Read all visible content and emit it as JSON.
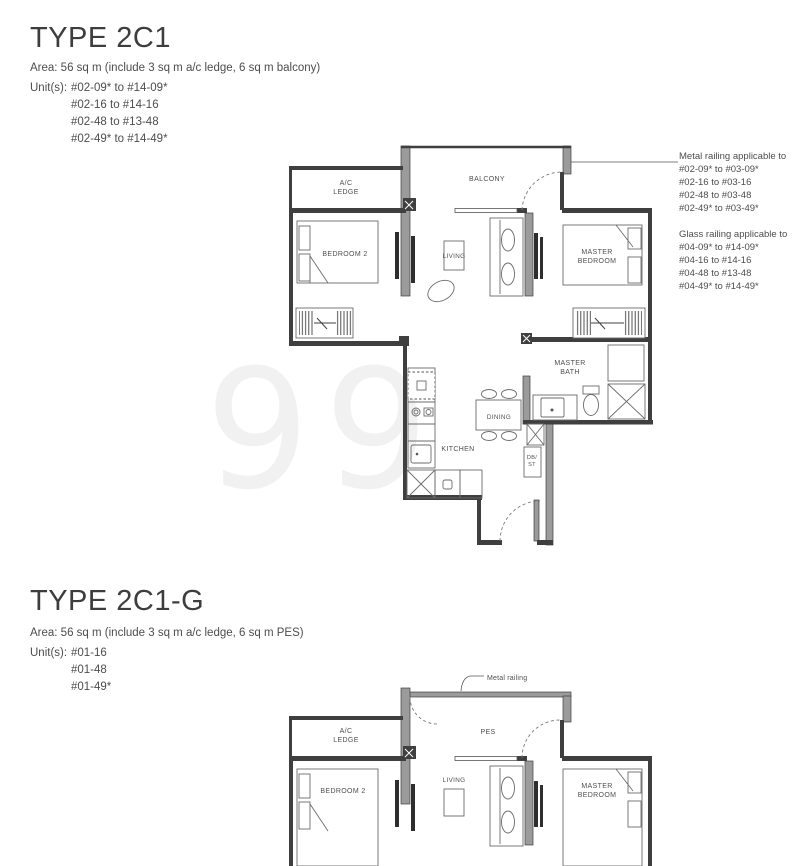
{
  "page": {
    "watermark": "99"
  },
  "section1": {
    "title": "TYPE 2C1",
    "area": "Area: 56 sq m (include 3 sq m a/c ledge, 6 sq m balcony)",
    "units_label": "Unit(s):",
    "units": [
      "#02-09* to #14-09*",
      "#02-16 to #14-16",
      "#02-48 to #13-48",
      "#02-49* to #14-49*"
    ],
    "rooms": {
      "ac_ledge_1": "A/C",
      "ac_ledge_2": "LEDGE",
      "balcony": "BALCONY",
      "bedroom2": "BEDROOM 2",
      "living": "LIVING",
      "master_bedroom_1": "MASTER",
      "master_bedroom_2": "BEDROOM",
      "master_bath_1": "MASTER",
      "master_bath_2": "BATH",
      "dining": "DINING",
      "kitchen": "KITCHEN",
      "dbst_1": "DB/",
      "dbst_2": "ST"
    },
    "annotations": {
      "metal_title": "Metal railing applicable to",
      "metal_lines": [
        "#02-09* to #03-09*",
        "#02-16 to #03-16",
        "#02-48 to #03-48",
        "#02-49* to #03-49*"
      ],
      "glass_title": "Glass railing applicable to",
      "glass_lines": [
        "#04-09* to #14-09*",
        "#04-16 to #14-16",
        "#04-48 to #13-48",
        "#04-49* to #14-49*"
      ]
    }
  },
  "section2": {
    "title": "TYPE 2C1-G",
    "area": "Area: 56 sq m (include 3 sq m a/c ledge, 6 sq m PES)",
    "units_label": "Unit(s):",
    "units": [
      "#01-16",
      "#01-48",
      "#01-49*"
    ],
    "rooms": {
      "ac_ledge_1": "A/C",
      "ac_ledge_2": "LEDGE",
      "pes": "PES",
      "bedroom2": "BEDROOM 2",
      "living": "LIVING",
      "master_bedroom_1": "MASTER",
      "master_bedroom_2": "BEDROOM"
    },
    "annotations": {
      "metal_railing": "Metal railing"
    }
  }
}
